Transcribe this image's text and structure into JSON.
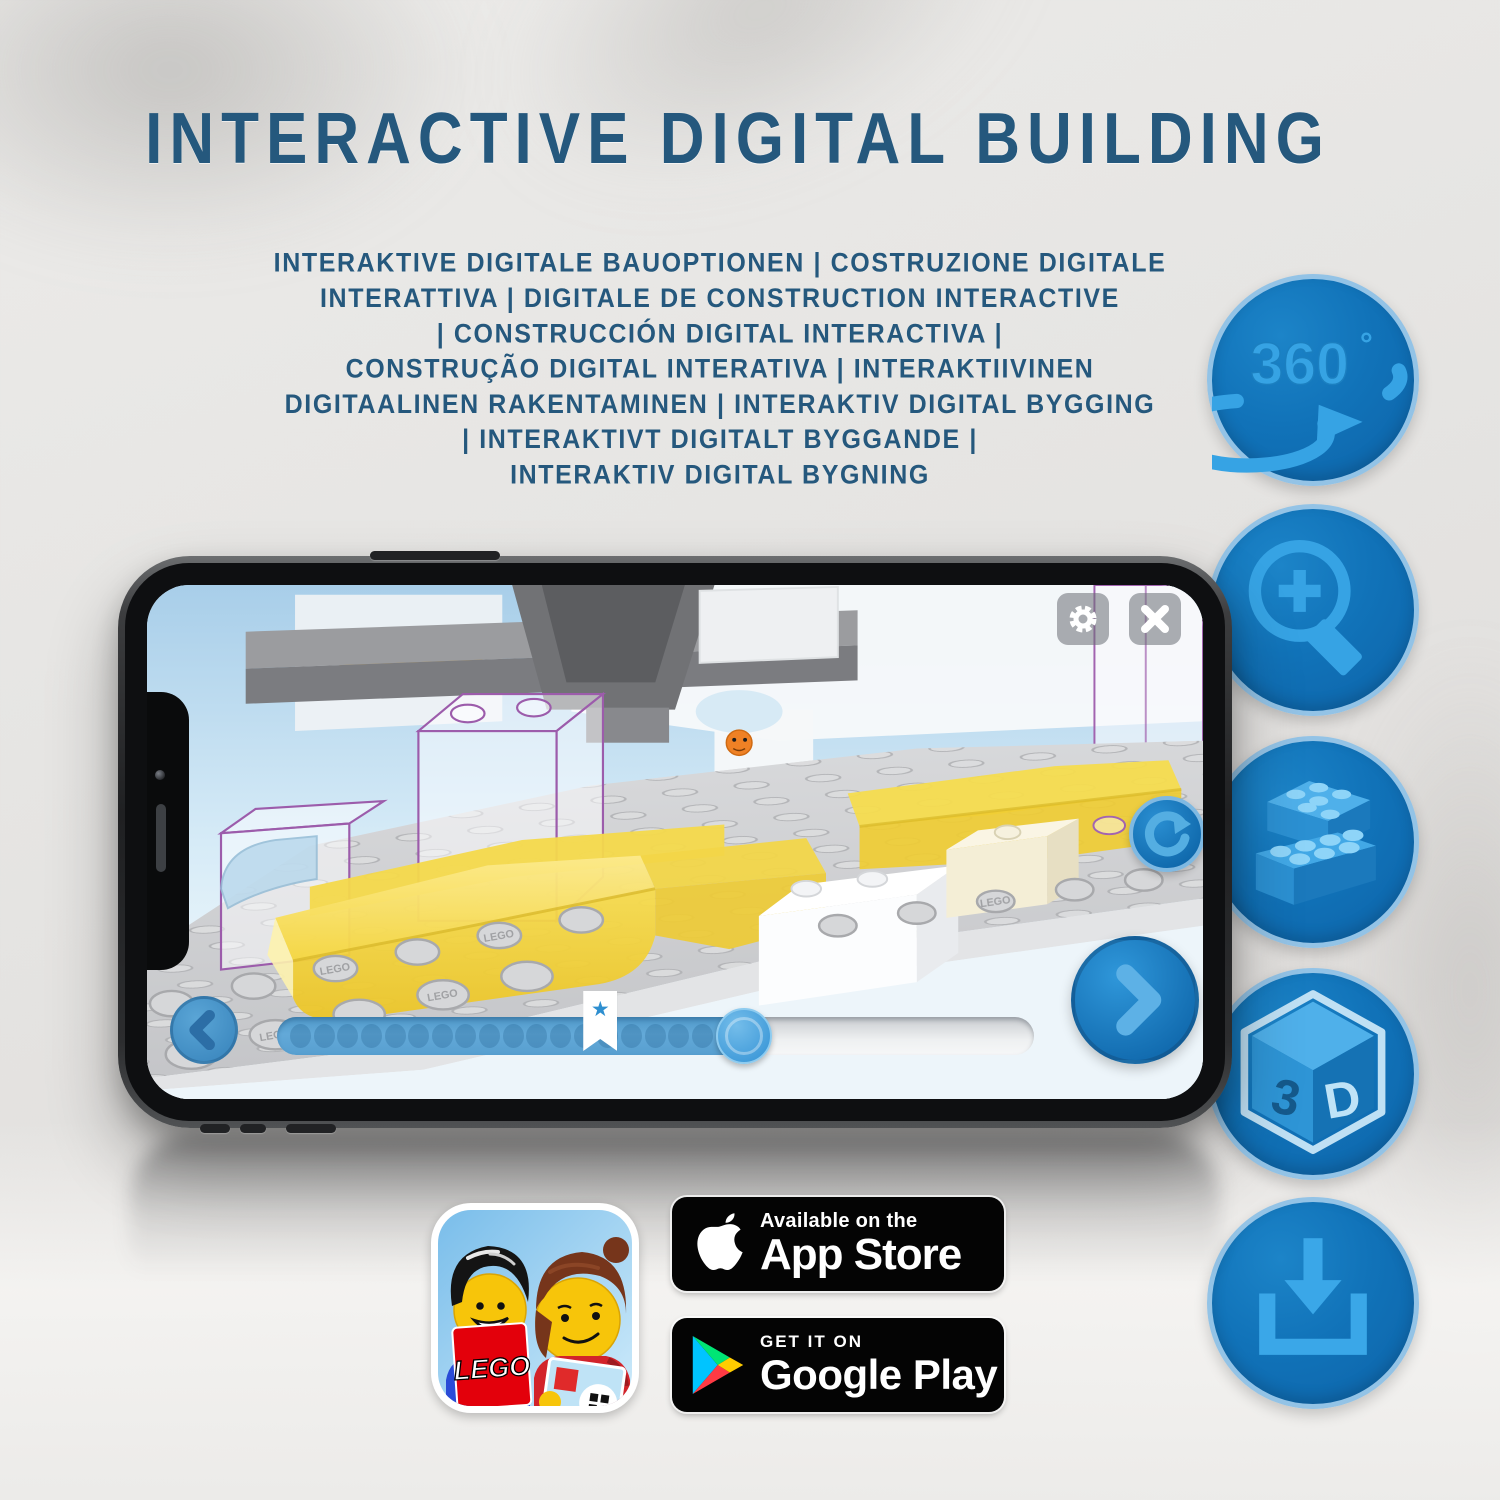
{
  "header": {
    "title": "INTERACTIVE DIGITAL BUILDING",
    "subtitle_lines": [
      "INTERAKTIVE DIGITALE BAUOPTIONEN | COSTRUZIONE DIGITALE",
      "INTERATTIVA | DIGITALE DE CONSTRUCTION INTERACTIVE",
      "| CONSTRUCCIÓN DIGITAL INTERACTIVA |",
      "CONSTRUÇÃO DIGITAL INTERATIVA | INTERAKTIIVINEN",
      "DIGITAALINEN RAKENTAMINEN | INTERAKTIV DIGITAL BYGGING",
      "| INTERAKTIVT DIGITALT BYGGANDE |",
      "INTERAKTIV DIGITAL BYGNING"
    ]
  },
  "feature_icons": {
    "rotation_360": {
      "label": "360",
      "degree": "°"
    },
    "cube_3d": {
      "left": "3",
      "right": "D"
    }
  },
  "phone": {
    "stud_embossing": "LEGO",
    "progress": {
      "dots_total": 18,
      "bookmark_star": "★",
      "bookmark_pos_pct": 42.7,
      "knob_pos_pct": 61.7,
      "fill_pct": 61.7
    }
  },
  "badges": {
    "app_store": {
      "line1": "Available on the",
      "line2": "App Store"
    },
    "google_play": {
      "line1": "GET IT ON",
      "line2": "Google Play"
    },
    "lego_app": {
      "logo_text": "LEGO"
    }
  },
  "colors": {
    "accent_dark_blue": "#25587d",
    "icon_circle_fill": "#1173b9",
    "icon_circle_rim": "#93c3e6",
    "icon_glyph_blue": "#36a3e4",
    "progress_fill": "#5ba4d4",
    "progress_knob": "#47a5e3",
    "nav_button_blue": "#1e87cf",
    "lego_yellow": "#f5d63f"
  }
}
